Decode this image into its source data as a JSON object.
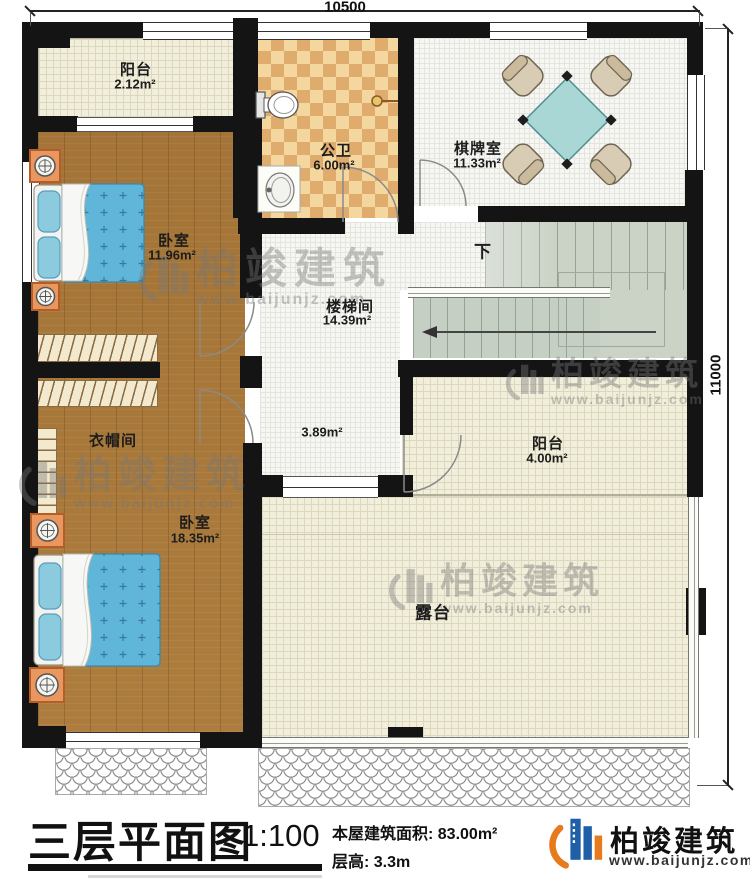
{
  "plan": {
    "dim_top": "10500",
    "dim_right": "11000",
    "rooms": {
      "balcony1": {
        "name": "阳台",
        "area": "2.12m²"
      },
      "bathroom": {
        "name": "公卫",
        "area": "6.00m²"
      },
      "chess_room": {
        "name": "棋牌室",
        "area": "11.33m²"
      },
      "bedroom1": {
        "name": "卧室",
        "area": "11.96m²"
      },
      "stairwell": {
        "name": "楼梯间",
        "area": "14.39m²"
      },
      "hallway": {
        "area": "3.89m²"
      },
      "cloakroom": {
        "name": "衣帽间"
      },
      "bedroom2": {
        "name": "卧室",
        "area": "18.35m²"
      },
      "balcony2": {
        "name": "阳台",
        "area": "4.00m²"
      },
      "terrace": {
        "name": "露台"
      }
    },
    "stair_direction": "下"
  },
  "watermark": {
    "brand": "柏竣建筑",
    "url": "www.baijunjz.com"
  },
  "title_block": {
    "drawing_title": "三层平面图",
    "scale": "1:100",
    "building_area": "本屋建筑面积: 83.00m²",
    "floor_height": "层高: 3.3m"
  },
  "logo": {
    "brand": "柏竣建筑",
    "url": "www.baijunjz.com"
  },
  "colors": {
    "wall": "#141414",
    "wood": "#ad7d3e",
    "tile_cream": "#f1eedb",
    "checker_light": "#f4d79e",
    "checker_dark": "#e0ac6e",
    "stair": "#cbd3c7",
    "bed": "#5fb6d8",
    "table": "#a8d7d5",
    "logo_blue": "#1f5fa8",
    "logo_orange": "#e87a1e"
  }
}
